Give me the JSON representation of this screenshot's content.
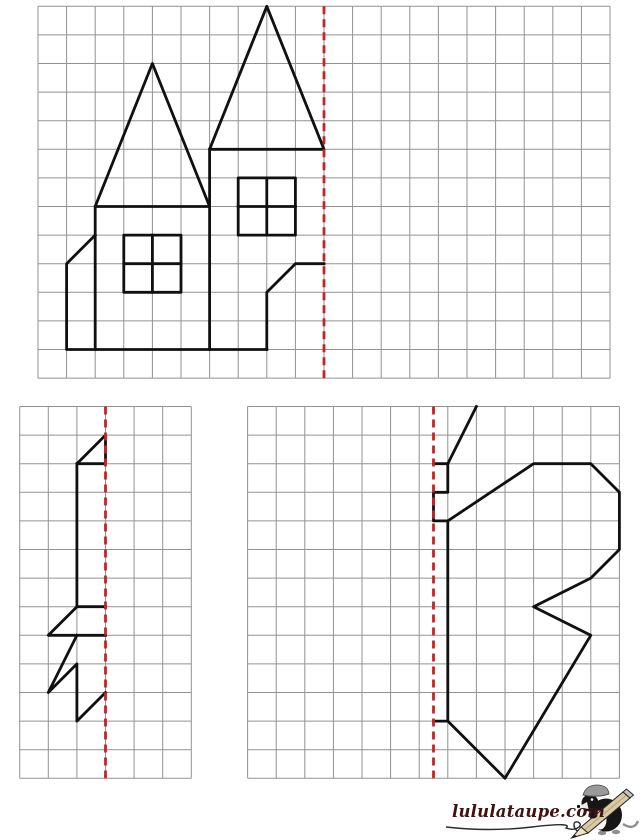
{
  "page": {
    "width": 640,
    "height": 840,
    "background": "#ffffff"
  },
  "style": {
    "grid_line_color": "#929292",
    "grid_line_width": 1,
    "figure_color": "#101010",
    "figure_line_width": 2.8,
    "axis_color": "#c42424",
    "axis_line_width": 2.8,
    "axis_dash_pattern": "8 5"
  },
  "worksheet": {
    "grids": [
      {
        "id": "house",
        "left": 38,
        "top": 6.3,
        "cols": 20,
        "rows": 13,
        "cell": 28.6,
        "axis_col": 10,
        "segments": [
          {
            "closed": true,
            "points": [
              [
                2,
                7
              ],
              [
                4,
                2
              ],
              [
                6,
                7
              ]
            ]
          },
          {
            "closed": true,
            "points": [
              [
                6,
                5
              ],
              [
                8,
                0
              ],
              [
                10,
                5
              ]
            ]
          },
          {
            "closed": false,
            "points": [
              [
                2,
                7
              ],
              [
                2,
                12
              ]
            ]
          },
          {
            "closed": false,
            "points": [
              [
                6,
                5
              ],
              [
                6,
                12
              ]
            ]
          },
          {
            "closed": false,
            "points": [
              [
                2,
                8
              ],
              [
                1,
                9
              ],
              [
                1,
                12
              ],
              [
                8,
                12
              ]
            ]
          },
          {
            "closed": false,
            "points": [
              [
                8,
                12
              ],
              [
                8,
                10
              ],
              [
                9,
                9
              ],
              [
                10,
                9
              ]
            ]
          },
          {
            "closed": true,
            "points": [
              [
                3,
                8
              ],
              [
                5,
                8
              ],
              [
                5,
                10
              ],
              [
                3,
                10
              ]
            ]
          },
          {
            "closed": false,
            "points": [
              [
                4,
                8
              ],
              [
                4,
                10
              ]
            ]
          },
          {
            "closed": false,
            "points": [
              [
                3,
                9
              ],
              [
                5,
                9
              ]
            ]
          },
          {
            "closed": true,
            "points": [
              [
                7,
                6
              ],
              [
                9,
                6
              ],
              [
                9,
                8
              ],
              [
                7,
                8
              ]
            ]
          },
          {
            "closed": false,
            "points": [
              [
                8,
                6
              ],
              [
                8,
                8
              ]
            ]
          },
          {
            "closed": false,
            "points": [
              [
                7,
                7
              ],
              [
                9,
                7
              ]
            ]
          }
        ]
      },
      {
        "id": "fir-tree",
        "left": 19.7,
        "top": 406.5,
        "cols": 6,
        "rows": 13,
        "cell": 28.6,
        "axis_col": 3,
        "segments": [
          {
            "closed": true,
            "points": [
              [
                3,
                1
              ],
              [
                2,
                2
              ],
              [
                3,
                2
              ]
            ]
          },
          {
            "closed": false,
            "points": [
              [
                2,
                2
              ],
              [
                2,
                7
              ]
            ]
          },
          {
            "closed": false,
            "points": [
              [
                3,
                7
              ],
              [
                2,
                7
              ],
              [
                1,
                8
              ],
              [
                3,
                8
              ]
            ]
          },
          {
            "closed": false,
            "points": [
              [
                2,
                8
              ],
              [
                1,
                10
              ],
              [
                2,
                9
              ],
              [
                2,
                11
              ],
              [
                3,
                10
              ]
            ]
          }
        ]
      },
      {
        "id": "butterfly",
        "left": 247.6,
        "top": 406.5,
        "cols": 13,
        "rows": 13,
        "cell": 28.6,
        "axis_col": 6.5,
        "segments": [
          {
            "closed": false,
            "points": [
              [
                8,
                0
              ],
              [
                7,
                2
              ],
              [
                6.5,
                2
              ]
            ]
          },
          {
            "closed": false,
            "points": [
              [
                7,
                2
              ],
              [
                7,
                3
              ],
              [
                6.5,
                3
              ],
              [
                6.5,
                4
              ],
              [
                7,
                4
              ],
              [
                7,
                11
              ],
              [
                6.5,
                11
              ]
            ]
          },
          {
            "closed": false,
            "points": [
              [
                7,
                4
              ],
              [
                10,
                2
              ],
              [
                12,
                2
              ],
              [
                13,
                3
              ],
              [
                13,
                5
              ],
              [
                12,
                6
              ],
              [
                10,
                7
              ],
              [
                12,
                8
              ],
              [
                9,
                13
              ],
              [
                7,
                11
              ]
            ]
          }
        ]
      }
    ]
  },
  "logo": {
    "text": "lululataupe.com",
    "color": "#421111"
  }
}
